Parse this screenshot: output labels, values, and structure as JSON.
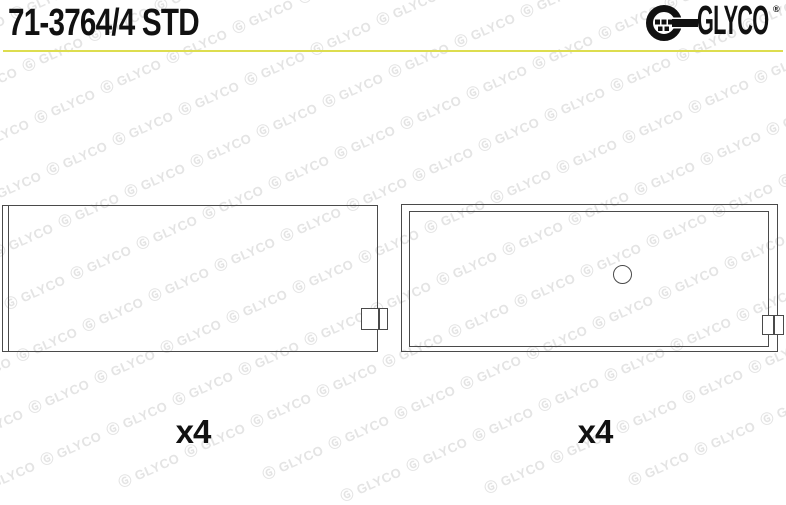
{
  "header": {
    "part_number": "71-3764/4 STD"
  },
  "brand": {
    "name": "GLYCO",
    "registered_mark": "®",
    "accent_color": "#dddd4f",
    "logo_color": "#111111"
  },
  "watermark": {
    "symbol": "Ⓖ",
    "text": "GLYCO",
    "color": "#e4e4e4"
  },
  "drawings": {
    "left": {
      "description": "bearing shell, plain, with locating tab",
      "quantity_label": "x4"
    },
    "right": {
      "description": "bearing shell with oil hole and locating tab",
      "quantity_label": "x4"
    }
  }
}
